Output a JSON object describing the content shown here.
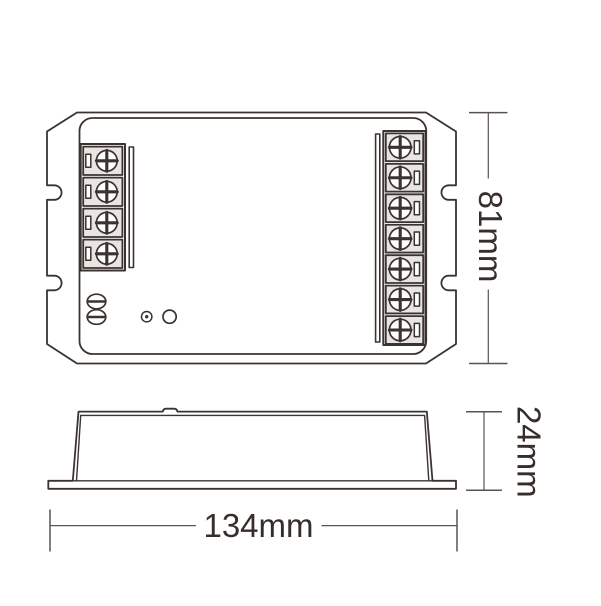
{
  "colors": {
    "line": "#3b332f",
    "dim_line": "#5a534f",
    "text": "#362e2a",
    "terminal_cell_fill": "#e8e5e2",
    "background": "#ffffff"
  },
  "dimensions": {
    "height_label": "81mm",
    "depth_label": "24mm",
    "width_label": "134mm"
  },
  "top_view": {
    "left_terminal_count": 4,
    "right_terminal_count": 7,
    "case_screw_count": 2,
    "has_led_indicator": true,
    "has_button_hole": true
  }
}
